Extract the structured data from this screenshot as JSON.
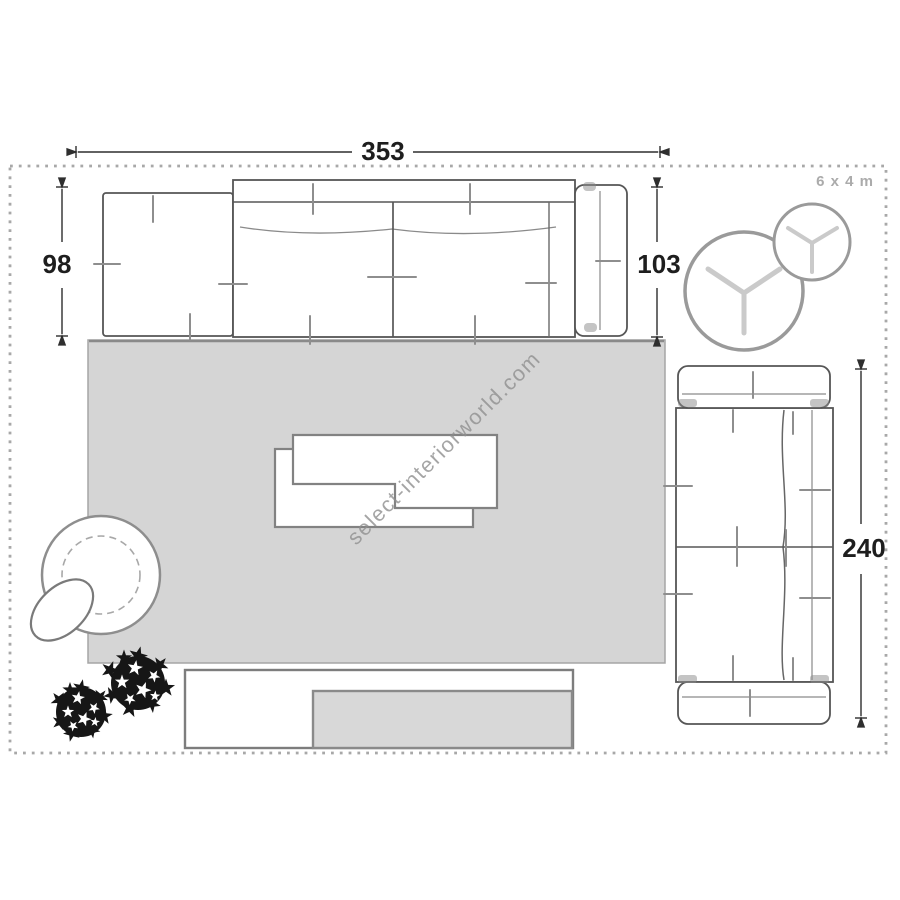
{
  "watermark": {
    "text": "select-interiorworld.com"
  },
  "room": {
    "size_label": "6 x 4 m"
  },
  "dimensions": {
    "sofa_total_width": "353",
    "open_end_depth": "98",
    "sofa_depth": "103",
    "second_sofa_length": "240"
  },
  "furniture": {
    "items": [
      "sectional-sofa-with-open-end",
      "two-seat-sofa",
      "round-side-table-large",
      "round-side-table-small",
      "two-tier-coffee-table",
      "rug",
      "swivel-armchair",
      "ottoman",
      "plant",
      "plant",
      "tv-sideboard",
      "tv"
    ]
  },
  "colors": {
    "rug_fill": "#d5d5d5",
    "furniture_fill": "#ffffff",
    "outline": "#565656",
    "muted_outline": "#9a9a9a",
    "tv_fill": "#d8d8d8",
    "dimension_text": "#1e1e1e",
    "room_label_text": "#ababab",
    "watermark_text": "#8f8f8f",
    "plant_fill": "#161616",
    "dashed_border": "#a8a8a8"
  }
}
